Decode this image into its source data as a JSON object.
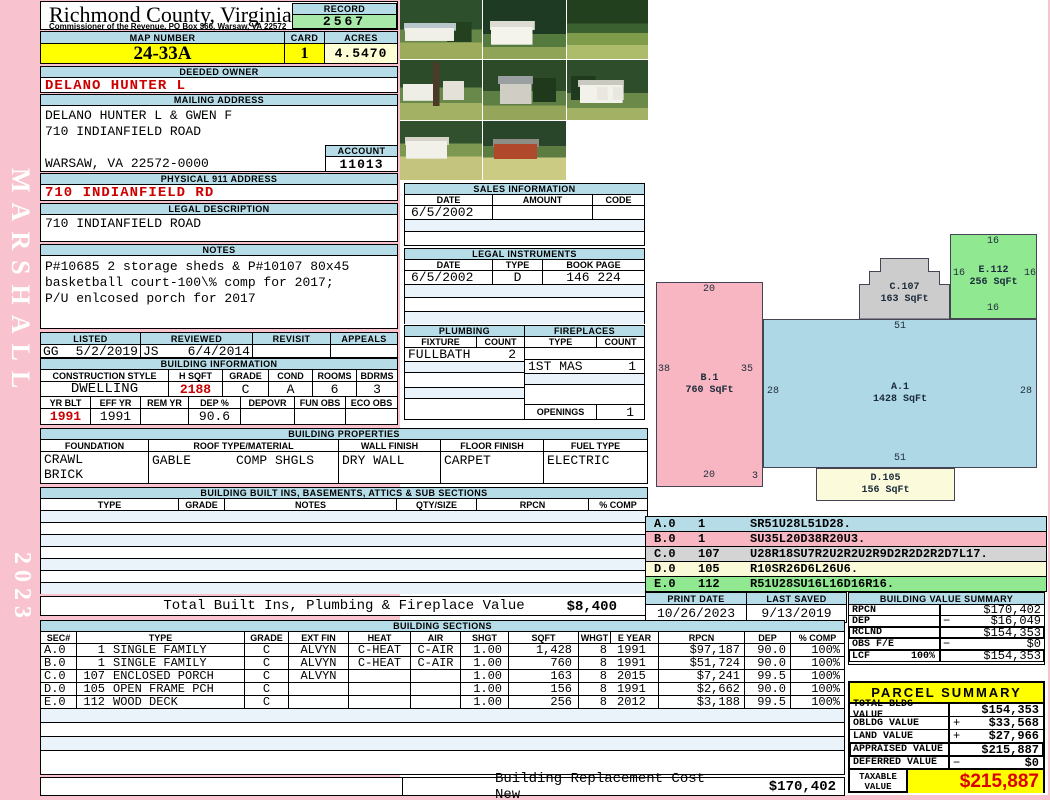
{
  "sidebar": {
    "vendor": "MARSHALL",
    "year": "2023"
  },
  "colors": {
    "page_bg": "#F8C3CF",
    "header_bar": "#B6DCE8",
    "record_bg": "#A8E8A8",
    "highlight_yellow": "#FFFF00",
    "acres_bg": "#FFFFD6",
    "alert_red": "#CC0000",
    "sketch_blue": "#AFD8E6",
    "sketch_pink": "#F8B6C2",
    "sketch_gray": "#CCCCCC",
    "sketch_green": "#90E890",
    "sketch_cream": "#FBFBDC"
  },
  "header": {
    "county": "Richmond County, Virginia",
    "commissioner": "Commissioner of the Revenue, PO Box 366, Warsaw, VA 22572",
    "record_label": "RECORD",
    "record_value": "2567",
    "map_label": "MAP NUMBER",
    "map_value": "24-33A",
    "card_label": "CARD",
    "card_value": "1",
    "acres_label": "ACRES",
    "acres_value": "4.5470"
  },
  "owner": {
    "deeded_label": "DEEDED OWNER",
    "deeded_value": "DELANO HUNTER L",
    "mailing_label": "MAILING ADDRESS",
    "mailing_lines": [
      "DELANO HUNTER L & GWEN F",
      "710 INDIANFIELD ROAD",
      "",
      "WARSAW, VA 22572-0000"
    ],
    "account_label": "ACCOUNT",
    "account_value": "11013",
    "physical_label": "PHYSICAL 911 ADDRESS",
    "physical_value": "710 INDIANFIELD RD",
    "legal_label": "LEGAL DESCRIPTION",
    "legal_value": "710 INDIANFIELD ROAD",
    "notes_label": "NOTES",
    "notes_lines": [
      "P#10685 2 storage sheds & P#10107 80x45",
      "basketball court-100\\% comp for 2017;",
      "P/U enlcosed porch for 2017"
    ]
  },
  "review": {
    "listed_label": "LISTED",
    "reviewed_label": "REVIEWED",
    "revisit_label": "REVISIT",
    "appeals_label": "APPEALS",
    "listed_by": "GG",
    "listed_date": "5/2/2019",
    "reviewed_by": "JS",
    "reviewed_date": "6/4/2014",
    "revisit_value": "",
    "appeals_value": ""
  },
  "building_info": {
    "title": "BUILDING INFORMATION",
    "labels1": [
      "CONSTRUCTION STYLE",
      "H SQFT",
      "GRADE",
      "COND",
      "ROOMS",
      "BDRMS"
    ],
    "values1": [
      "DWELLING",
      "2188",
      "C",
      "A",
      "6",
      "3"
    ],
    "labels2": [
      "YR BLT",
      "EFF YR",
      "REM YR",
      "DEP %",
      "DEPOVR",
      "FUN OBS",
      "ECO OBS"
    ],
    "values2": [
      "1991",
      "1991",
      "",
      "90.6",
      "",
      "",
      ""
    ]
  },
  "building_properties": {
    "title": "BUILDING PROPERTIES",
    "labels": [
      "FOUNDATION",
      "ROOF TYPE/MATERIAL",
      "WALL FINISH",
      "FLOOR FINISH",
      "FUEL TYPE"
    ],
    "foundation_lines": [
      "CRAWL",
      "BRICK"
    ],
    "roof_type": "GABLE",
    "roof_material": "COMP SHGLS",
    "wall_finish": "DRY WALL",
    "floor_finish": "CARPET",
    "fuel_type": "ELECTRIC"
  },
  "built_ins": {
    "title": "BUILDING BUILT INS, BASEMENTS, ATTICS & SUB SECTIONS",
    "labels": [
      "TYPE",
      "GRADE",
      "NOTES",
      "QTY/SIZE",
      "RPCN",
      "% COMP"
    ],
    "total_label": "Total Built Ins, Plumbing & Fireplace Value",
    "total_value": "$8,400"
  },
  "photos": {
    "names": [
      "house-front",
      "garage-white",
      "yard-trees",
      "house-side-with-tree",
      "shed-gray",
      "garage-two-door",
      "garage-in-field",
      "shed-red-in-field"
    ]
  },
  "sales": {
    "title": "SALES INFORMATION",
    "labels": [
      "DATE",
      "AMOUNT",
      "CODE"
    ],
    "rows": [
      [
        "6/5/2002",
        "",
        ""
      ]
    ]
  },
  "instruments": {
    "title": "LEGAL INSTRUMENTS",
    "labels": [
      "DATE",
      "TYPE",
      "BOOK PAGE"
    ],
    "rows": [
      [
        "6/5/2002",
        "D",
        "146 224"
      ]
    ]
  },
  "plumbing": {
    "title": "PLUMBING",
    "labels": [
      "FIXTURE",
      "COUNT"
    ],
    "rows": [
      [
        "FULLBATH",
        "2"
      ]
    ]
  },
  "fireplaces": {
    "title": "FIREPLACES",
    "labels": [
      "TYPE",
      "COUNT"
    ],
    "rows": [
      [
        "",
        ""
      ],
      [
        "1ST MAS",
        "1"
      ]
    ],
    "openings_label": "OPENINGS",
    "openings_value": "1"
  },
  "sketch": {
    "a1": {
      "name": "A.1",
      "sqft": "1428 SqFt",
      "dim_top": "51",
      "dim_bottom": "51",
      "dim_left": "28",
      "dim_right": "28"
    },
    "b1": {
      "name": "B.1",
      "sqft": "760 SqFt",
      "dim_top": "20",
      "dim_bottom": "20",
      "dim_left": "38",
      "dim_right": "35",
      "dim_corner": "3"
    },
    "c107": {
      "name": "C.107",
      "sqft": "163 SqFt"
    },
    "d105": {
      "name": "D.105",
      "sqft": "156 SqFt"
    },
    "e112": {
      "name": "E.112",
      "sqft": "256 SqFt",
      "dim_top": "16",
      "dim_bottom": "16",
      "dim_left": "16",
      "dim_right": "16"
    }
  },
  "legend": [
    {
      "sec": "A.0",
      "num": "1",
      "trace": "SR51U28L51D28.",
      "color": "#B6DCE8"
    },
    {
      "sec": "B.0",
      "num": "1",
      "trace": "SU35L20D38R20U3.",
      "color": "#F8B6C2"
    },
    {
      "sec": "C.0",
      "num": "107",
      "trace": "U28R18SU7R2U2R2U2R9D2R2D2R2D7L17.",
      "color": "#D4D4D4"
    },
    {
      "sec": "D.0",
      "num": "105",
      "trace": "R10SR26D6L26U6.",
      "color": "#FAFAD8"
    },
    {
      "sec": "E.0",
      "num": "112",
      "trace": "R51U28SU16L16D16R16.",
      "color": "#90E890"
    }
  ],
  "print_info": {
    "print_date_label": "PRINT DATE",
    "print_date": "10/26/2023",
    "last_saved_label": "LAST SAVED",
    "last_saved": "9/13/2019"
  },
  "value_summary": {
    "title": "BUILDING VALUE SUMMARY",
    "rows": [
      {
        "label": "RPCN",
        "pct": "",
        "sign": "",
        "value": "$170,402"
      },
      {
        "label": "DEP",
        "pct": "",
        "sign": "−",
        "value": "$16,049"
      },
      {
        "label": "RCLND",
        "pct": "",
        "sign": "",
        "value": "$154,353"
      },
      {
        "label": "OBS F/E",
        "pct": "",
        "sign": "−",
        "value": "$0"
      },
      {
        "label": "LCF",
        "pct": "100%",
        "sign": "",
        "value": "$154,353"
      }
    ]
  },
  "building_sections": {
    "title": "BUILDING SECTIONS",
    "labels": [
      "SEC#",
      "TYPE",
      "GRADE",
      "EXT FIN",
      "HEAT",
      "AIR",
      "SHGT",
      "SQFT",
      "WHGT",
      "E YEAR",
      "RPCN",
      "DEP",
      "% COMP"
    ],
    "rows": [
      {
        "sec": "A.0",
        "num": "1",
        "type": "SINGLE FAMILY",
        "grade": "C",
        "ext": "ALVYN",
        "heat": "C-HEAT",
        "air": "C-AIR",
        "shgt": "1.00",
        "sqft": "1,428",
        "whgt": "8",
        "eyear": "1991",
        "rpcn": "$97,187",
        "dep": "90.0",
        "comp": "100%"
      },
      {
        "sec": "B.0",
        "num": "1",
        "type": "SINGLE FAMILY",
        "grade": "C",
        "ext": "ALVYN",
        "heat": "C-HEAT",
        "air": "C-AIR",
        "shgt": "1.00",
        "sqft": "760",
        "whgt": "8",
        "eyear": "1991",
        "rpcn": "$51,724",
        "dep": "90.0",
        "comp": "100%"
      },
      {
        "sec": "C.0",
        "num": "107",
        "type": "ENCLOSED PORCH",
        "grade": "C",
        "ext": "ALVYN",
        "heat": "",
        "air": "",
        "shgt": "1.00",
        "sqft": "163",
        "whgt": "8",
        "eyear": "2015",
        "rpcn": "$7,241",
        "dep": "99.5",
        "comp": "100%"
      },
      {
        "sec": "D.0",
        "num": "105",
        "type": "OPEN FRAME PCH",
        "grade": "C",
        "ext": "",
        "heat": "",
        "air": "",
        "shgt": "1.00",
        "sqft": "156",
        "whgt": "8",
        "eyear": "1991",
        "rpcn": "$2,662",
        "dep": "90.0",
        "comp": "100%"
      },
      {
        "sec": "E.0",
        "num": "112",
        "type": "WOOD DECK",
        "grade": "C",
        "ext": "",
        "heat": "",
        "air": "",
        "shgt": "1.00",
        "sqft": "256",
        "whgt": "8",
        "eyear": "2012",
        "rpcn": "$3,188",
        "dep": "99.5",
        "comp": "100%"
      }
    ]
  },
  "parcel_summary": {
    "title": "PARCEL SUMMARY",
    "rows": [
      {
        "label": "TOTAL BLDG VALUE",
        "sign": "",
        "value": "$154,353"
      },
      {
        "label": "OBLDG VALUE",
        "sign": "+",
        "value": "$33,568"
      },
      {
        "label": "LAND VALUE",
        "sign": "+",
        "value": "$27,966"
      },
      {
        "label": "APPRAISED VALUE",
        "sign": "",
        "value": "$215,887"
      },
      {
        "label": "DEFERRED VALUE",
        "sign": "−",
        "value": "$0"
      }
    ],
    "taxable_line1": "TAXABLE",
    "taxable_line2": "VALUE",
    "taxable_value": "$215,887"
  },
  "footer": {
    "rcn_label": "Building Replacement Cost New",
    "rcn_value": "$170,402"
  }
}
